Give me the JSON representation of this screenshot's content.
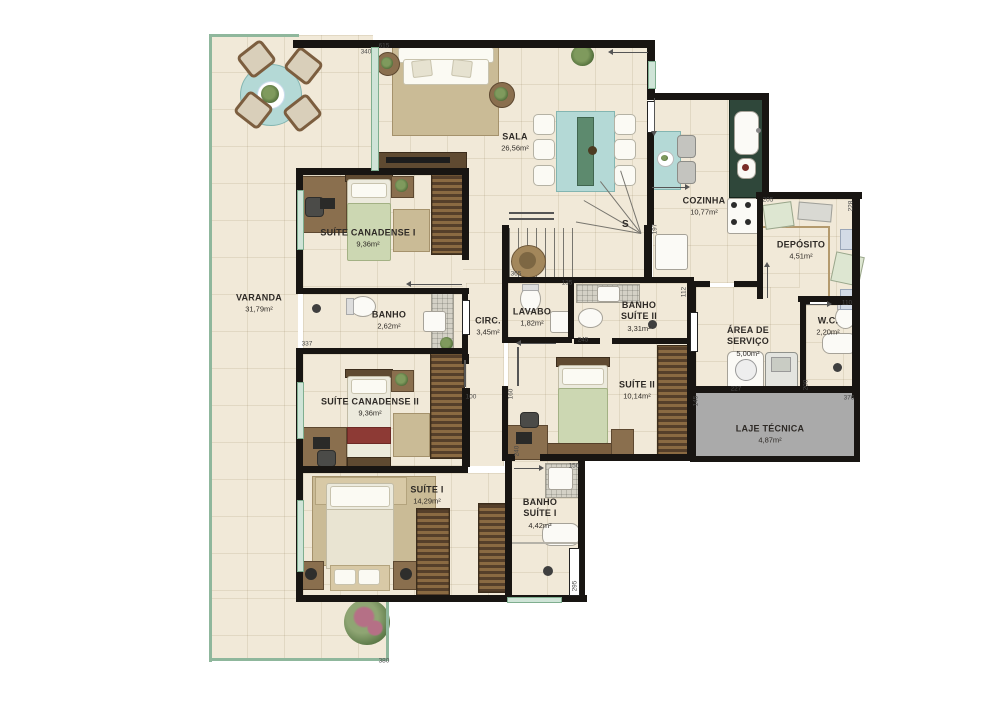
{
  "plan": {
    "stair_label": "S",
    "rooms": [
      {
        "name": "VARANDA",
        "area": "31,79m²",
        "x": 259,
        "y": 303
      },
      {
        "name": "SALA",
        "area": "26,56m²",
        "x": 515,
        "y": 142
      },
      {
        "name": "COZINHA",
        "area": "10,77m²",
        "x": 704,
        "y": 206
      },
      {
        "name": "DEPÓSITO",
        "area": "4,51m²",
        "x": 801,
        "y": 250
      },
      {
        "name": "SUÍTE CANADENSE I",
        "area": "9,36m²",
        "x": 368,
        "y": 238
      },
      {
        "name": "BANHO",
        "area": "2,62m²",
        "x": 389,
        "y": 320
      },
      {
        "name": "CIRC.",
        "area": "3,45m²",
        "x": 488,
        "y": 326
      },
      {
        "name": "LAVABO",
        "area": "1,82m²",
        "x": 532,
        "y": 317
      },
      {
        "name": "BANHO\nSUÍTE II",
        "area": "3,31m²",
        "x": 639,
        "y": 316
      },
      {
        "name": "ÁREA DE\nSERVIÇO",
        "area": "5,00m²",
        "x": 748,
        "y": 341
      },
      {
        "name": "W.C.",
        "area": "2,20m²",
        "x": 828,
        "y": 326
      },
      {
        "name": "SUÍTE II",
        "area": "10,14m²",
        "x": 637,
        "y": 390
      },
      {
        "name": "SUÍTE CANADENSE II",
        "area": "9,36m²",
        "x": 370,
        "y": 407
      },
      {
        "name": "LAJE TÉCNICA",
        "area": "4,87m²",
        "x": 770,
        "y": 434
      },
      {
        "name": "SUÍTE I",
        "area": "14,29m²",
        "x": 427,
        "y": 495
      },
      {
        "name": "BANHO\nSUÍTE I",
        "area": "4,42m²",
        "x": 540,
        "y": 513
      }
    ],
    "dimensions": [
      {
        "v": "340",
        "x": 366,
        "y": 52,
        "rot": 0
      },
      {
        "v": "615",
        "x": 384,
        "y": 46,
        "rot": 0
      },
      {
        "v": "365",
        "x": 516,
        "y": 274,
        "rot": 0
      },
      {
        "v": "135",
        "x": 567,
        "y": 283,
        "rot": 0
      },
      {
        "v": "197",
        "x": 655,
        "y": 229,
        "rot": 1
      },
      {
        "v": "112",
        "x": 684,
        "y": 292,
        "rot": 1
      },
      {
        "v": "245",
        "x": 583,
        "y": 340,
        "rot": 0
      },
      {
        "v": "100",
        "x": 471,
        "y": 397,
        "rot": 0
      },
      {
        "v": "160",
        "x": 511,
        "y": 394,
        "rot": 1
      },
      {
        "v": "240",
        "x": 517,
        "y": 451,
        "rot": 1
      },
      {
        "v": "337",
        "x": 307,
        "y": 344,
        "rot": 0
      },
      {
        "v": "227",
        "x": 736,
        "y": 389,
        "rot": 0
      },
      {
        "v": "145",
        "x": 696,
        "y": 401,
        "rot": 1
      },
      {
        "v": "200",
        "x": 806,
        "y": 385,
        "rot": 1
      },
      {
        "v": "110",
        "x": 847,
        "y": 303,
        "rot": 0
      },
      {
        "v": "376",
        "x": 849,
        "y": 398,
        "rot": 0
      },
      {
        "v": "205",
        "x": 768,
        "y": 200,
        "rot": 0
      },
      {
        "v": "228",
        "x": 851,
        "y": 206,
        "rot": 1
      },
      {
        "v": "150",
        "x": 574,
        "y": 466,
        "rot": 0
      },
      {
        "v": "295",
        "x": 575,
        "y": 586,
        "rot": 1
      },
      {
        "v": "380",
        "x": 384,
        "y": 661,
        "rot": 0
      }
    ]
  },
  "colors": {
    "wall": "#181512",
    "floor": "#f1e9d8",
    "varanda_border": "#8fb79c",
    "window_mint": "#cfe4d7",
    "counter_green": "#2f473a",
    "furniture_teal": "#b4d9d6",
    "wood": "#8a6f4e",
    "wood_dark": "#5f4a31",
    "laje_gray": "#aaaaaa",
    "rug": "#cabb96",
    "bed_green": "#ccd7b2",
    "accent_red": "#8d3a35",
    "fixture_white": "#fbfaf6",
    "label_text": "#2e2a26"
  }
}
